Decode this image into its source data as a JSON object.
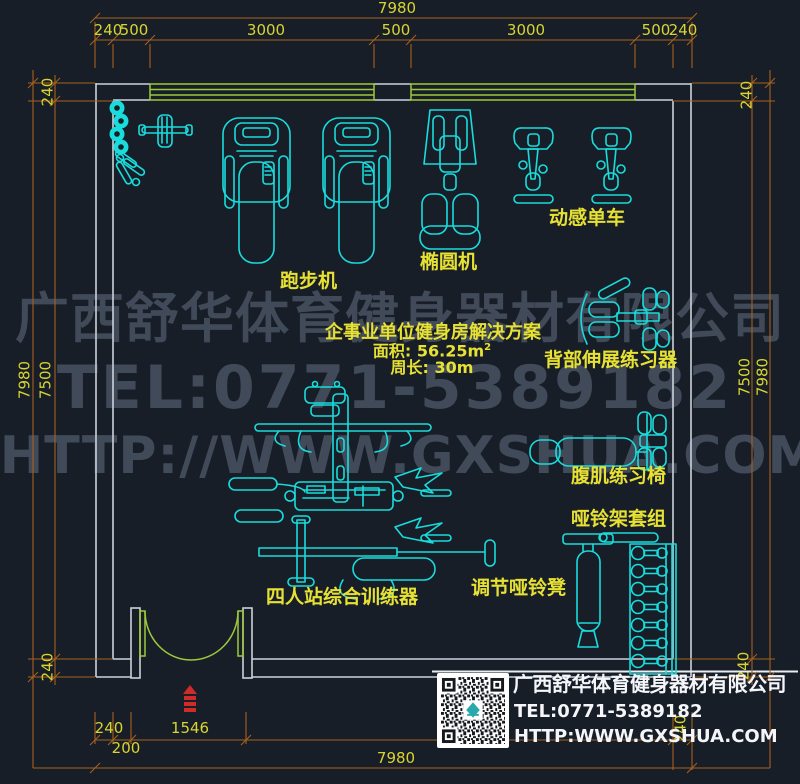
{
  "colors": {
    "bg": "#181e28",
    "wall": "#ccd2da",
    "cad": "#19dcdc",
    "green": "#9cc93a",
    "dim": "#a8611d",
    "dimtext": "#d9d42f",
    "label": "#e6e133",
    "red": "#cf2b28",
    "watermark": "#414a58",
    "white": "#f4f6fa"
  },
  "dims": {
    "top_total": "7980",
    "top_segments": [
      "240",
      "500",
      "3000",
      "500",
      "3000",
      "500",
      "240"
    ],
    "left_outer": "7980",
    "left_inner": "7500",
    "left_top": "240",
    "left_bottom": "240",
    "right_outer": "7980",
    "right_inner": "7500",
    "right_top": "240",
    "right_bottom": "240",
    "bottom_wall": "240",
    "bottom_pier": "200",
    "bottom_door": "1546",
    "bottom_right_wall": "240",
    "bottom_total": "7980"
  },
  "labels": {
    "treadmill": "跑步机",
    "elliptical": "椭圆机",
    "spin_bike": "动感单车",
    "back_extension": "背部伸展练习器",
    "ab_chair": "腹肌练习椅",
    "dumbbell_rack": "哑铃架套组",
    "dumbbell_bench": "调节哑铃凳",
    "multi_station": "四人站综合训练器"
  },
  "info": {
    "title": "企事业单位健身房解决方案",
    "area": "面积: 56.25m",
    "area_sup": "2",
    "perimeter": "周长: 30m"
  },
  "watermark": {
    "line1": "广西舒华体育健身器材有限公司",
    "line2": "TEL:0771-5389182",
    "line3": "HTTP://WWW.GXSHUA.COM"
  },
  "company": {
    "name": "广西舒华体育健身器材有限公司",
    "tel": "TEL:0771-5389182",
    "url": "HTTP:WWW.GXSHUA.COM"
  }
}
